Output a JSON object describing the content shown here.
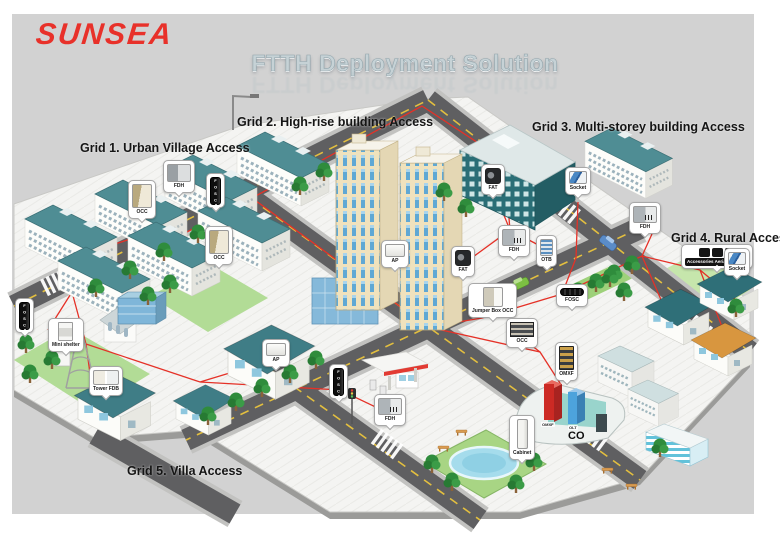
{
  "logo": {
    "text": "SUNSEA"
  },
  "title": {
    "text": "FTTH Deployment Solution"
  },
  "grid_labels": [
    {
      "id": "grid-1",
      "text": "Grid 1. Urban Village Access"
    },
    {
      "id": "grid-2",
      "text": "Grid 2. High-rise building Access"
    },
    {
      "id": "grid-3",
      "text": "Grid 3. Multi-storey building Access"
    },
    {
      "id": "grid-4",
      "text": "Grid 4. Rural Access"
    },
    {
      "id": "grid-5",
      "text": "Grid 5. Villa Access"
    }
  ],
  "co_site": {
    "label": "CO",
    "omxf_label": "OMXF",
    "olt_label": "OLT"
  },
  "callouts": [
    {
      "id": "occ-urban-1",
      "label": "OCC",
      "equipment": "outdoor-connection-cabinet"
    },
    {
      "id": "fdh-urban",
      "label": "FDH",
      "equipment": "fiber-distribution-hub"
    },
    {
      "id": "fosc-urban",
      "label": "FOSC",
      "equipment": "fiber-optic-splice-closure-vertical"
    },
    {
      "id": "occ-urban-2",
      "label": "OCC",
      "equipment": "outdoor-connection-cabinet"
    },
    {
      "id": "fat-multistorey",
      "label": "FAT",
      "equipment": "fiber-access-terminal"
    },
    {
      "id": "socket-multistorey",
      "label": "Socket",
      "equipment": "fiber-socket"
    },
    {
      "id": "fdh-highrise",
      "label": "FDH",
      "equipment": "fiber-distribution-hub"
    },
    {
      "id": "otb-multistorey",
      "label": "OTB",
      "equipment": "optical-terminal-box"
    },
    {
      "id": "ap-highrise",
      "label": "AP",
      "equipment": "access-point-panel"
    },
    {
      "id": "fat-highrise",
      "label": "FAT",
      "equipment": "fiber-access-terminal"
    },
    {
      "id": "jumper-box-occ",
      "label": "Jumper Box OCC",
      "equipment": "jumper-box-cabinet"
    },
    {
      "id": "fosc-road",
      "label": "FOSC",
      "equipment": "fiber-optic-splice-closure-horizontal"
    },
    {
      "id": "fdh-rural",
      "label": "FDH",
      "equipment": "fiber-distribution-hub"
    },
    {
      "id": "accessories-aerial",
      "label": "Accessories Aerial mounted",
      "equipment": "aerial-mounting-accessories"
    },
    {
      "id": "socket-rural",
      "label": "Socket",
      "equipment": "fiber-socket"
    },
    {
      "id": "fosc-west",
      "label": "FOSC",
      "equipment": "fiber-optic-splice-closure-vertical"
    },
    {
      "id": "mini-shelter",
      "label": "Mini shelter",
      "equipment": "mini-shelter-cabinet"
    },
    {
      "id": "tower-fdb",
      "label": "Tower FDB",
      "equipment": "tower-fiber-distribution-box"
    },
    {
      "id": "ap-villa",
      "label": "AP",
      "equipment": "access-point-panel"
    },
    {
      "id": "fosc-villa",
      "label": "FOSC",
      "equipment": "fiber-optic-splice-closure-vertical"
    },
    {
      "id": "fdh-villa",
      "label": "FDH",
      "equipment": "fiber-distribution-hub"
    },
    {
      "id": "occ-co",
      "label": "OCC",
      "equipment": "optical-connection-rack"
    },
    {
      "id": "omxf-co",
      "label": "OMXF",
      "equipment": "optical-main-distribution-frame"
    },
    {
      "id": "cabinet-co",
      "label": "Cabinet",
      "equipment": "street-cabinet"
    }
  ],
  "colors": {
    "logo_red": "#e8312a",
    "title_gray": "#c6d2d6",
    "fiber_red": "#e53127",
    "roof_teal": "#4f8d94",
    "multistorey_teal": "#2a6e76",
    "highrise_cream": "#efe2bd",
    "background_gray": "#d2d2d2"
  }
}
